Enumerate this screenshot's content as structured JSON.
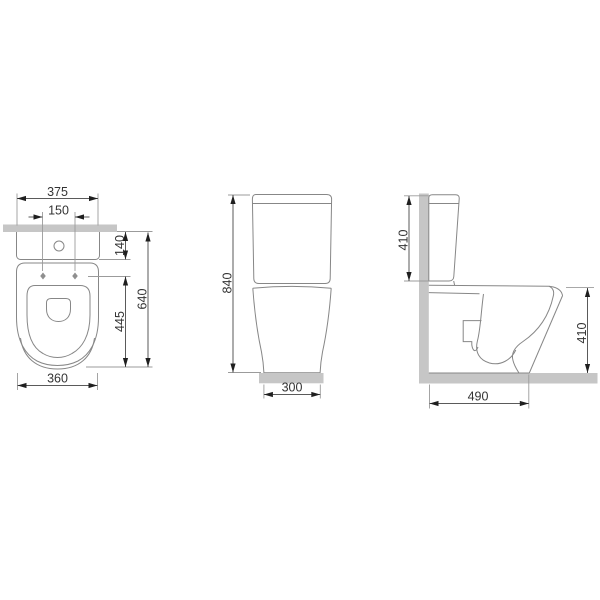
{
  "colors": {
    "background": "#ffffff",
    "object_outline": "#878787",
    "dimension_line": "#5a5a5a",
    "extension_line": "#9b9b9b",
    "arrowhead": "#1f1f1f",
    "label_text": "#333333",
    "wall_floor_gray": "#c6c6c6"
  },
  "top_view": {
    "overall_width": "375",
    "fixing_holes_spacing": "150",
    "cistern_depth": "140",
    "pan_depth": "445",
    "overall_depth": "640",
    "pan_width": "360"
  },
  "front_view": {
    "overall_height": "840",
    "base_width": "300"
  },
  "side_view": {
    "cistern_height": "410",
    "pan_height": "410",
    "overall_depth": "490"
  }
}
